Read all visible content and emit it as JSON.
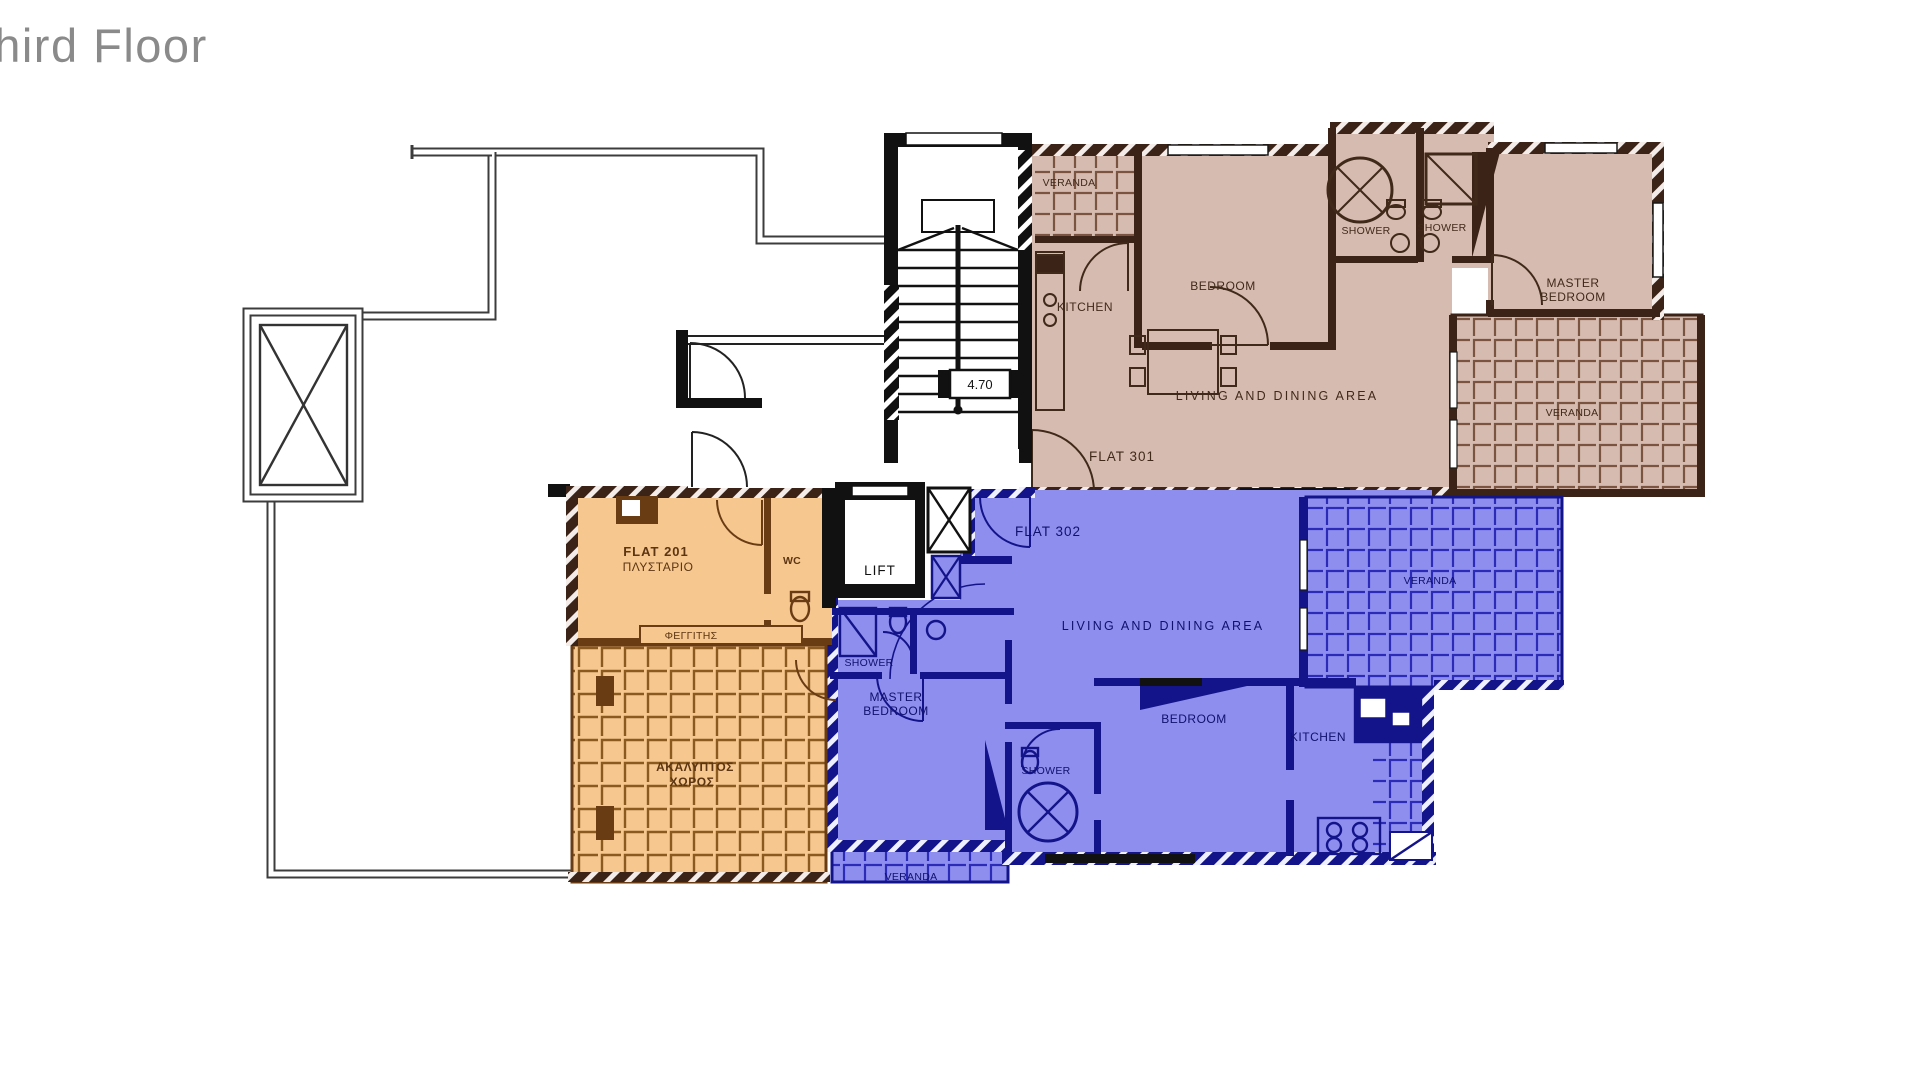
{
  "title": "Third Floor",
  "colors": {
    "flat301_fill": "#d6bcb0",
    "flat301_wall": "#3c2317",
    "flat302_fill": "#8e8eef",
    "flat302_wall": "#14148a",
    "flat201_fill": "#f6c78f",
    "flat201_wall": "#6a3c14",
    "outline": "#3c3c3c",
    "title_gray": "#8a8a8a"
  },
  "core": {
    "lift": "LIFT",
    "stair_dim": "4.70"
  },
  "flat301": {
    "name": "FLAT 301",
    "veranda_top": "VERANDA",
    "kitchen": "KITCHEN",
    "bedroom": "BEDROOM",
    "shower_left": "SHOWER",
    "shower_right": "SHOWER",
    "master_line1": "MASTER",
    "master_line2": "BEDROOM",
    "living": "LIVING AND DINING AREA",
    "veranda_right": "VERANDA"
  },
  "flat302": {
    "name": "FLAT 302",
    "shower_top": "SHOWER",
    "master_line1": "MASTER",
    "master_line2": "BEDROOM",
    "shower_mid": "SHOWER",
    "bedroom": "BEDROOM",
    "kitchen": "KITCHEN",
    "living": "LIVING AND DINING AREA",
    "veranda_right": "VERANDA",
    "veranda_bottom": "VERANDA"
  },
  "flat201": {
    "name_line1": "FLAT 201",
    "name_line2": "ΠΛΥΣΤΑΡΙΟ",
    "wc": "WC",
    "skylight": "ΦΕΓΓΙΤΗΣ",
    "open_area_line1": "ΑΚΑΛΥΠΤΟΣ",
    "open_area_line2": "ΧΩΡΟΣ"
  }
}
